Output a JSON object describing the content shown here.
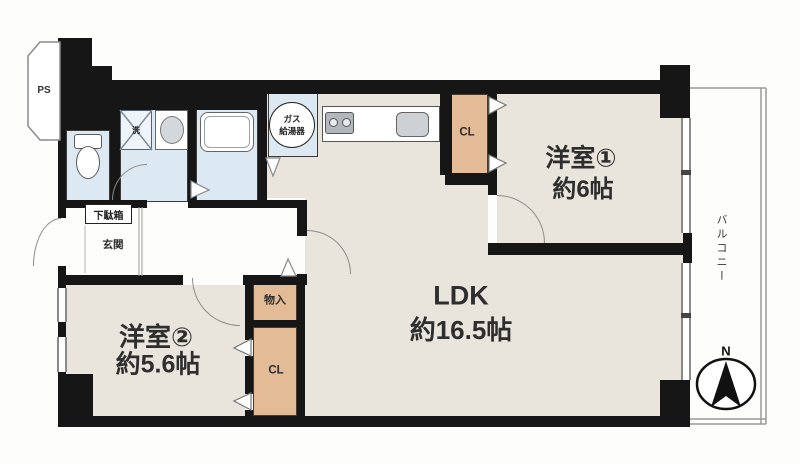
{
  "plan_title": "apartment-floor-plan",
  "colors": {
    "wall": "#161616",
    "floor": "#e9e5dc",
    "wet_area": "#dde9f2",
    "closet": "#e4bb97",
    "line": "#8c8c8c"
  },
  "rooms": {
    "ldk": {
      "name": "LDK",
      "size": "約16.5帖"
    },
    "bedroom1": {
      "name": "洋室①",
      "size": "約6帖"
    },
    "bedroom2": {
      "name": "洋室②",
      "size": "約5.6帖"
    },
    "balcony": {
      "name": "バルコニー"
    },
    "genkan": {
      "name": "玄関"
    }
  },
  "features": {
    "ps": "PS",
    "gas_heater_line1": "ガス",
    "gas_heater_line2": "給湯器",
    "laundry": "洗",
    "shoe_cabinet": "下駄箱",
    "storage": "物入",
    "closet_top": "CL",
    "closet_bottom": "CL",
    "north": "N"
  }
}
